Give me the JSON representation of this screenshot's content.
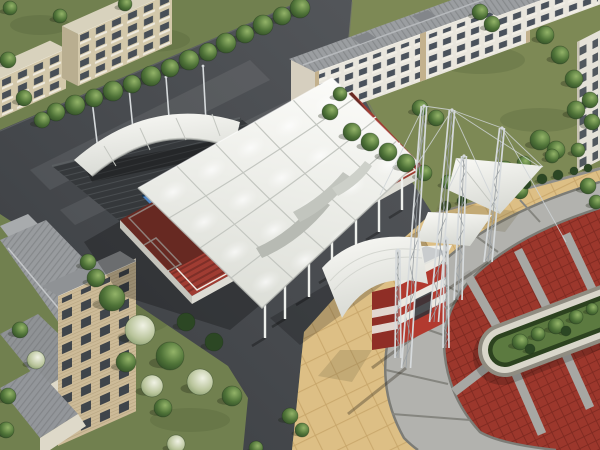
{
  "meta": {
    "title": "Aerial 3D architectural rendering: white tensile-membrane canopy sports complex with red court, lattice masts and entrance gate, circular paved plaza with oval garden island, surrounded by apartment buildings, tree-lined asphalt roads and lawns",
    "type": "3d-architectural-render",
    "view": "aerial-isometric"
  },
  "scene": {
    "elements": [
      "main-tensile-canopy",
      "red-sports-court",
      "bleacher-steps",
      "support-columns",
      "secondary-arched-canopy",
      "stepped-dark-deck",
      "blue-pool-court",
      "lattice-truss-masts",
      "suspension-cables",
      "walkway-membrane-sails",
      "entrance-gate-kiosk",
      "gate-awning",
      "circular-plaza",
      "stone-walkway-ring",
      "red-brick-paving",
      "paving-spokes",
      "oval-garden-island",
      "island-hedge",
      "island-trees",
      "apartment-buildings",
      "tree-rows",
      "lawns",
      "asphalt-roads",
      "gable-roof-houses"
    ]
  },
  "colors": {
    "grass": "#71804f",
    "grassLight": "#7e8a55",
    "treeDark": "#2c4724",
    "plazaTan": "#ddbf85",
    "plazaGrid": "#c8a66a",
    "ringGray": "#b2b2ae",
    "ringEdge": "#7c7c76",
    "brickRed": "#9c372c",
    "brickLine": "#7f2a21",
    "stone": "#d9d6ca",
    "hedge": "#2c421f",
    "gardenGreen": "#5c7a40",
    "courtRed": "#a03c32",
    "courtDark": "#7e2f28",
    "lineWhite": "#efe9e2",
    "pool": "#4d85c4",
    "mast": "#d6dadc",
    "mastDark": "#9aa0a4",
    "cable": "#cfd4d7",
    "gateRed": "#b23a2f",
    "gateDark": "#8f2e26",
    "gateWhite": "#ebe9e2",
    "beige": "#d3c8aa",
    "beigeDark": "#b9ae90",
    "bwhite": "#e9e6dd",
    "cream": "#ded9c9",
    "winDark": "#39424e",
    "roofGray": "#9b9ea1",
    "roofDark": "#8f9295",
    "deck": "#35383b",
    "deckStripe": "#494d50",
    "seam": "#c3c6c0",
    "canopyEdge": "#b9bcb6"
  },
  "trees": {
    "groups": [
      {
        "name": "road-row",
        "items": [
          [
            300,
            8,
            10,
            0
          ],
          [
            282,
            16,
            9,
            0
          ],
          [
            263,
            25,
            10,
            0
          ],
          [
            245,
            34,
            9,
            0
          ],
          [
            226,
            43,
            10,
            0
          ],
          [
            208,
            52,
            9,
            0
          ],
          [
            189,
            60,
            10,
            0
          ],
          [
            170,
            68,
            9,
            0
          ],
          [
            151,
            76,
            10,
            0
          ],
          [
            132,
            84,
            9,
            0
          ],
          [
            113,
            91,
            10,
            0
          ],
          [
            94,
            98,
            9,
            0
          ],
          [
            75,
            105,
            10,
            0
          ],
          [
            56,
            112,
            9,
            0
          ]
        ]
      },
      {
        "name": "top-left",
        "items": [
          [
            8,
            60,
            8,
            0
          ],
          [
            24,
            98,
            8,
            0
          ],
          [
            42,
            120,
            8,
            0
          ],
          [
            60,
            16,
            7,
            0
          ],
          [
            125,
            4,
            7,
            0
          ],
          [
            10,
            8,
            7,
            0
          ]
        ]
      },
      {
        "name": "top-right",
        "items": [
          [
            330,
            112,
            8,
            0
          ],
          [
            340,
            94,
            7,
            0
          ],
          [
            352,
            132,
            9,
            0
          ],
          [
            370,
            142,
            9,
            0
          ],
          [
            388,
            152,
            9,
            0
          ],
          [
            406,
            163,
            9,
            0
          ],
          [
            424,
            173,
            8,
            0
          ],
          [
            480,
            12,
            8,
            0
          ],
          [
            492,
            24,
            8,
            0
          ],
          [
            545,
            35,
            9,
            0
          ],
          [
            560,
            55,
            9,
            0
          ],
          [
            574,
            79,
            9,
            0
          ],
          [
            590,
            100,
            8,
            0
          ],
          [
            540,
            140,
            10,
            0
          ],
          [
            556,
            150,
            9,
            0
          ],
          [
            505,
            170,
            9,
            0
          ],
          [
            494,
            186,
            8,
            0
          ],
          [
            520,
            191,
            8,
            0
          ],
          [
            588,
            186,
            8,
            0
          ],
          [
            596,
            202,
            7,
            0
          ],
          [
            420,
            108,
            8,
            0
          ],
          [
            436,
            118,
            8,
            0
          ],
          [
            576,
            110,
            9,
            0
          ],
          [
            592,
            122,
            8,
            0
          ]
        ]
      },
      {
        "name": "hedge-row",
        "items": [
          [
            446,
            206,
            5,
            1
          ],
          [
            462,
            201,
            5,
            1
          ],
          [
            478,
            197,
            5,
            1
          ],
          [
            494,
            192,
            5,
            1
          ],
          [
            510,
            188,
            5,
            1
          ],
          [
            526,
            184,
            5,
            1
          ],
          [
            542,
            179,
            5,
            1
          ],
          [
            558,
            175,
            5,
            1
          ],
          [
            574,
            171,
            4,
            1
          ],
          [
            588,
            168,
            4,
            1
          ],
          [
            448,
            182,
            7,
            0
          ],
          [
            472,
            176,
            7,
            0
          ],
          [
            498,
            170,
            7,
            0
          ],
          [
            524,
            163,
            7,
            0
          ],
          [
            552,
            156,
            7,
            0
          ],
          [
            578,
            150,
            7,
            0
          ]
        ]
      },
      {
        "name": "garden",
        "items": [
          [
            88,
            262,
            8,
            0
          ],
          [
            96,
            278,
            9,
            0
          ],
          [
            112,
            298,
            13,
            0
          ],
          [
            140,
            330,
            15,
            2
          ],
          [
            170,
            356,
            14,
            0
          ],
          [
            200,
            382,
            13,
            2
          ],
          [
            126,
            362,
            10,
            0
          ],
          [
            214,
            342,
            9,
            1
          ],
          [
            232,
            396,
            10,
            0
          ],
          [
            186,
            322,
            9,
            1
          ]
        ]
      },
      {
        "name": "bottom",
        "items": [
          [
            152,
            386,
            11,
            2
          ],
          [
            163,
            408,
            9,
            0
          ],
          [
            290,
            416,
            8,
            0
          ],
          [
            302,
            430,
            7,
            0
          ],
          [
            20,
            330,
            8,
            0
          ],
          [
            36,
            360,
            9,
            2
          ],
          [
            8,
            396,
            8,
            0
          ],
          [
            176,
            444,
            9,
            2
          ],
          [
            256,
            448,
            7,
            0
          ],
          [
            6,
            430,
            8,
            0
          ]
        ]
      },
      {
        "name": "island",
        "items": [
          [
            520,
            342,
            8,
            0
          ],
          [
            538,
            334,
            7,
            0
          ],
          [
            556,
            326,
            8,
            0
          ],
          [
            576,
            317,
            7,
            0
          ],
          [
            592,
            309,
            6,
            0
          ],
          [
            530,
            349,
            5,
            1
          ],
          [
            566,
            331,
            5,
            1
          ]
        ]
      }
    ]
  },
  "structures": {
    "columns": [
      [
        265,
        305
      ],
      [
        285,
        286
      ],
      [
        309,
        264
      ],
      [
        332,
        242
      ],
      [
        356,
        220
      ],
      [
        379,
        199
      ],
      [
        402,
        177
      ]
    ],
    "poles": [
      [
        98,
        150,
        92,
        100
      ],
      [
        134,
        140,
        129,
        88
      ],
      [
        170,
        131,
        166,
        77
      ],
      [
        206,
        122,
        203,
        66
      ]
    ],
    "masts": [
      {
        "b": [
          406,
          368
        ],
        "t": [
          424,
          106
        ],
        "w": 4.5
      },
      {
        "b": [
          434,
          322
        ],
        "t": [
          452,
          110
        ],
        "w": 4.5
      },
      {
        "b": [
          458,
          300
        ],
        "t": [
          464,
          156
        ],
        "w": 4
      },
      {
        "b": [
          488,
          262
        ],
        "t": [
          502,
          128
        ],
        "w": 4
      },
      {
        "b": [
          398,
          358
        ],
        "t": [
          398,
          250
        ],
        "w": 3
      },
      {
        "b": [
          446,
          348
        ],
        "t": [
          446,
          238
        ],
        "w": 3
      }
    ],
    "cables": [
      [
        424,
        106,
        418,
        163
      ],
      [
        424,
        106,
        380,
        195
      ],
      [
        452,
        110,
        540,
        167
      ],
      [
        452,
        110,
        498,
        210
      ],
      [
        502,
        128,
        543,
        167
      ],
      [
        502,
        128,
        566,
        242
      ],
      [
        464,
        156,
        448,
        190
      ],
      [
        424,
        106,
        452,
        110
      ],
      [
        452,
        110,
        502,
        128
      ],
      [
        418,
        163,
        452,
        110
      ]
    ],
    "mast_shadows": [
      [
        406,
        368,
        348,
        414
      ],
      [
        434,
        322,
        372,
        368
      ],
      [
        458,
        300,
        398,
        342
      ],
      [
        488,
        262,
        432,
        300
      ]
    ]
  }
}
